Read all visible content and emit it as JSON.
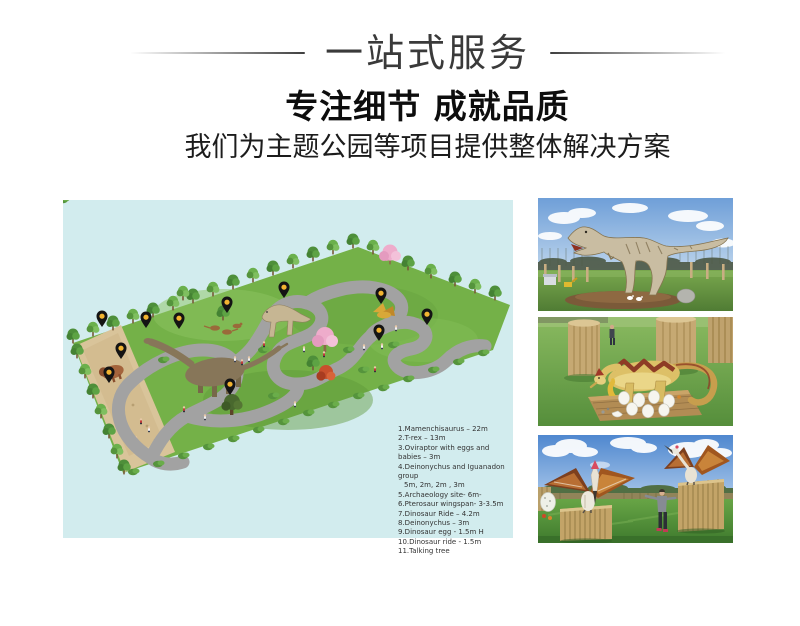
{
  "header": {
    "title": "一站式服务",
    "subtitle": "专注细节 成就品质",
    "tagline": "我们为主题公园等项目提供整体解决方案",
    "title_color": "#3a3a3a",
    "text_color": "#0d0d0d"
  },
  "map": {
    "background_color": "#d2ecee",
    "grass_color": "#74b148",
    "path_color": "#a2a2a2",
    "sand_color": "#d9c49a",
    "pin_color": "#141414",
    "pin_dot_color": "#f2b431",
    "legend": {
      "text_color": "#333333",
      "lines": [
        "1.Mamenchisaurus – 22m",
        "2.T-rex – 13m",
        "3.Oviraptor with eggs and babies – 3m",
        "4.Deinonychus and Iguanadon group",
        "5m, 2m, 2m , 3m",
        "5.Archaeology site- 6m-",
        "6.Pterosaur  wingspan- 3-3.5m",
        "7.Dinosaur Ride – 4.2m",
        "8.Deinonychus – 3m",
        "9.Dinosaur egg - 1.5m H",
        "10.Dinosaur ride -  1.5m",
        "11.Talking tree"
      ]
    }
  },
  "photos": {
    "first": "t-rex animatronic",
    "second": "dinosaur with eggs",
    "third": "pterosaurs on fences"
  }
}
